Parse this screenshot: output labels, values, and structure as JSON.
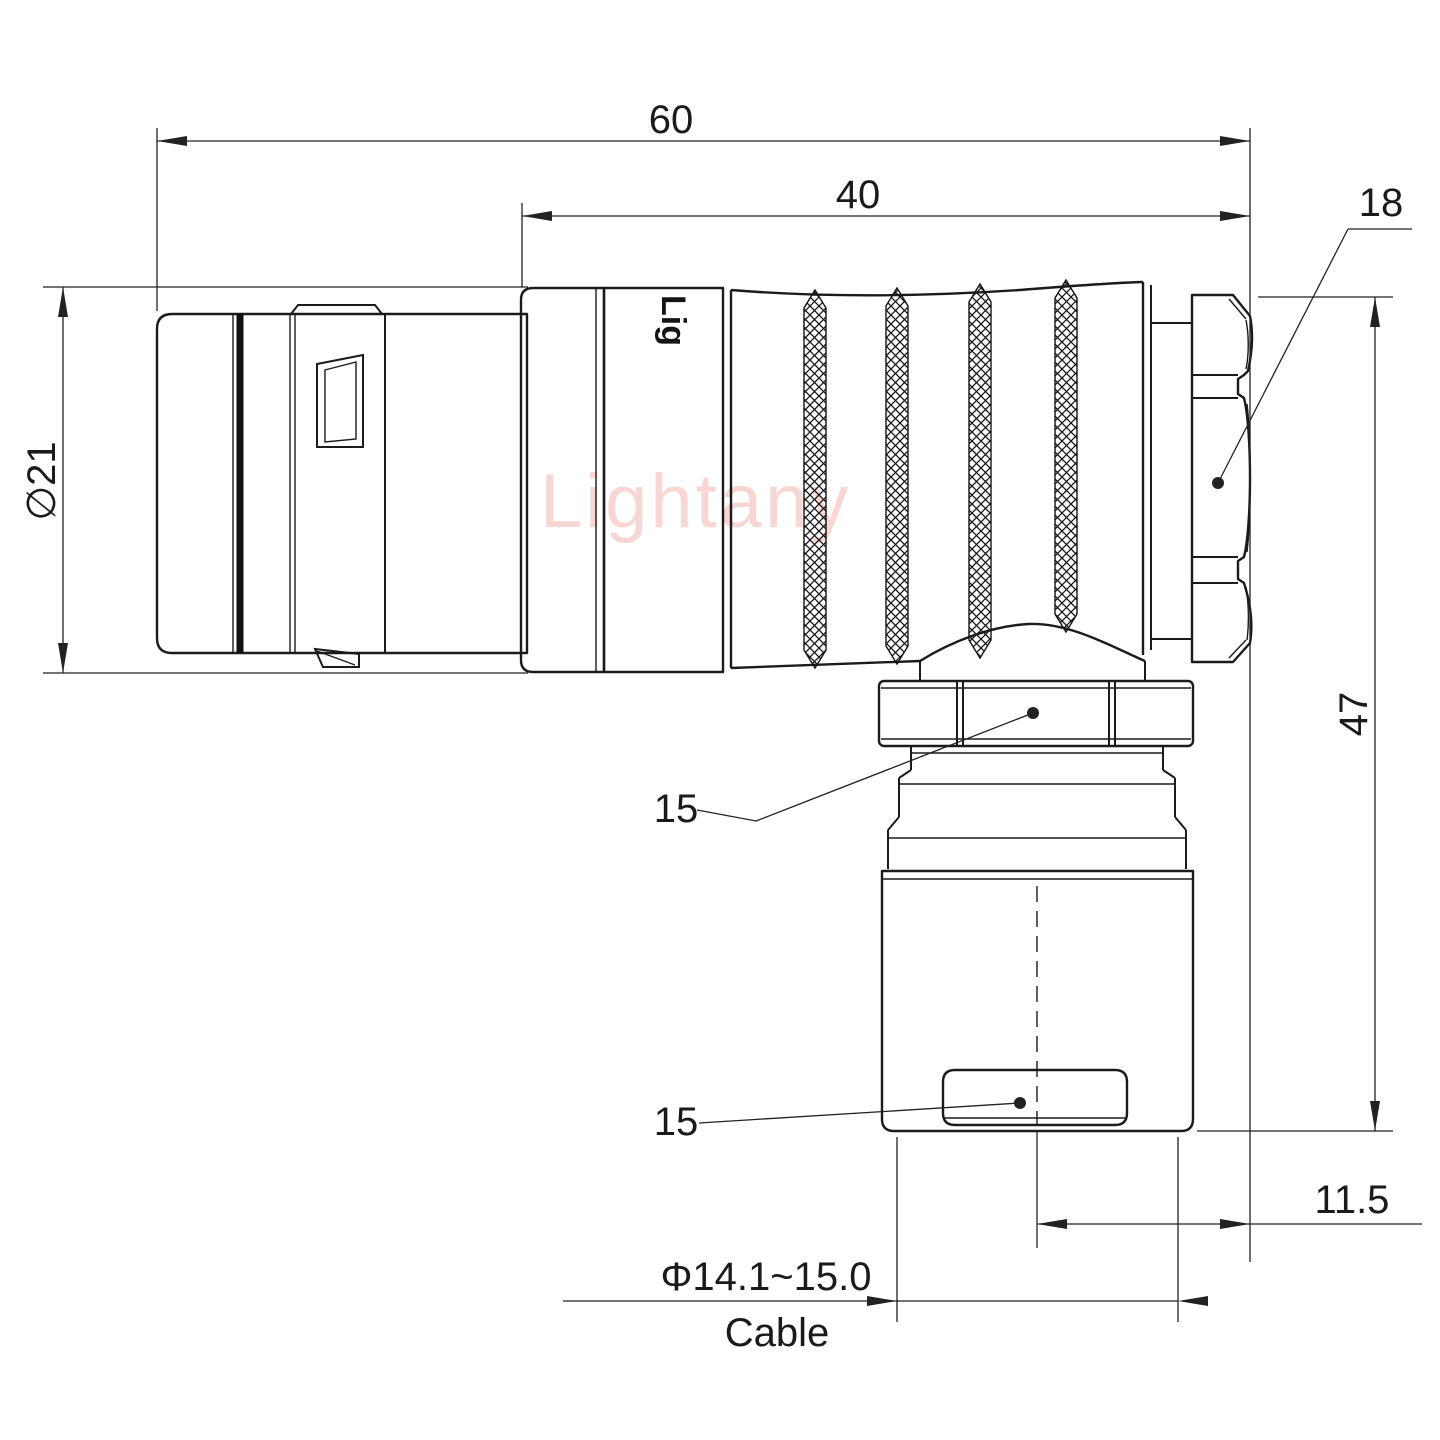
{
  "drawing": {
    "type": "technical-drawing",
    "subject": "right-angle circular push-pull connector, side view",
    "watermark": {
      "text": "Lightany",
      "color": "#f8d6d3"
    },
    "engraving": {
      "text": "Lig"
    },
    "colors": {
      "line": "#1b1b1b",
      "dimension": "#222222",
      "background": "#ffffff"
    },
    "dimensions": {
      "overall_length": "60",
      "rear_length": "40",
      "end_nut_size": "18",
      "shell_diameter": "∅21",
      "total_height": "47",
      "elbow_nut_size": "15",
      "clamp_size": "15",
      "cable_axis_offset": "11.5",
      "cable_diameter_range": "Φ14.1~15.0",
      "cable_caption": "Cable"
    }
  }
}
